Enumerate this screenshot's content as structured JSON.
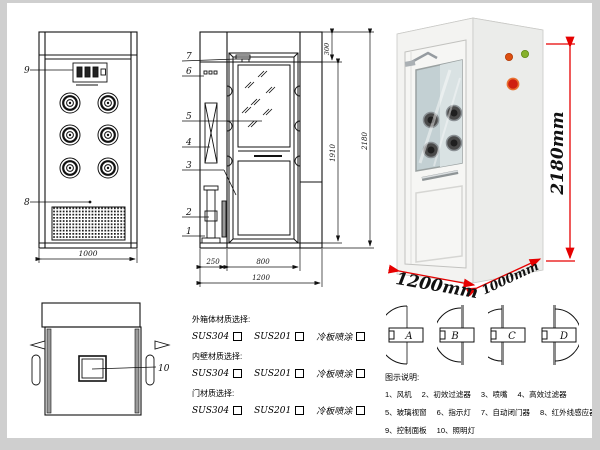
{
  "front_view": {
    "callout_9": "9",
    "callout_8": "8",
    "dim_width": "1000"
  },
  "side_view": {
    "callouts": [
      "7",
      "6",
      "5",
      "4",
      "3",
      "2",
      "1"
    ],
    "dim_top": "300",
    "dim_door_height": "1910",
    "dim_total_height": "2180",
    "dim_left_col": "250",
    "dim_door_width": "800",
    "dim_total_width": "1200"
  },
  "top_view": {
    "callout_10": "10"
  },
  "photo": {
    "dim_height": "2180mm",
    "dim_width": "1200mm",
    "dim_depth": "1000mm",
    "dim_color": "#e60000"
  },
  "materials": {
    "sections": [
      {
        "title": "外箱体材质选择:",
        "options": [
          "SUS304",
          "SUS201",
          "冷板喷涂"
        ]
      },
      {
        "title": "内壁材质选择:",
        "options": [
          "SUS304",
          "SUS201",
          "冷板喷涂"
        ]
      },
      {
        "title": "门材质选择:",
        "options": [
          "SUS304",
          "SUS201",
          "冷板喷涂"
        ]
      }
    ]
  },
  "door_directions": {
    "labels": [
      "A",
      "B",
      "C",
      "D"
    ]
  },
  "legend": {
    "title": "图示说明:",
    "items": [
      "1、风机",
      "2、初效过滤器",
      "3、喷嘴",
      "4、高效过滤器",
      "5、玻璃视窗",
      "6、指示灯",
      "7、自动闭门器",
      "8、红外线感应器",
      "9、控制面板",
      "10、照明灯"
    ]
  }
}
